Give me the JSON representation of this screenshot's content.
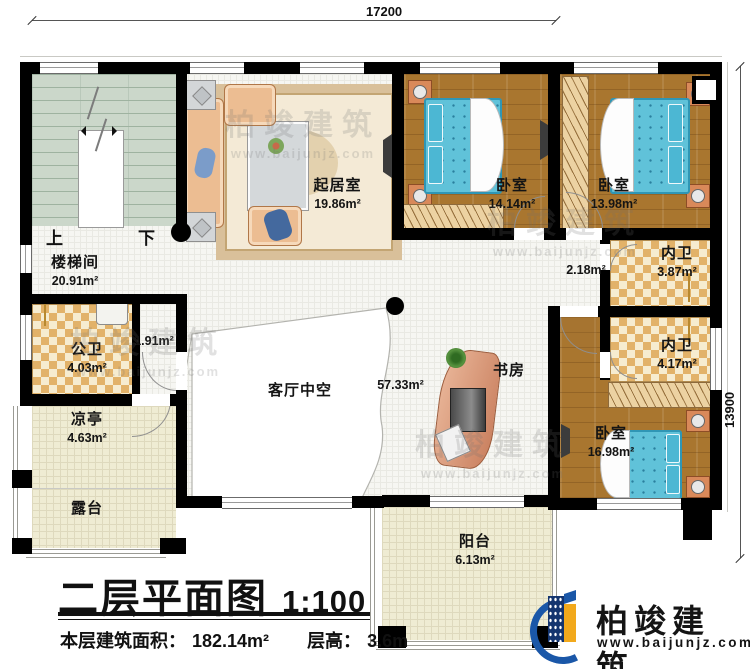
{
  "dimensions": {
    "top": "17200",
    "right": "13900"
  },
  "stairs": {
    "up": "上",
    "down": "下"
  },
  "rooms": {
    "stairwell": {
      "name": "楼梯间",
      "area": "20.91m²"
    },
    "living": {
      "name": "起居室",
      "area": "19.86m²"
    },
    "bedroom1": {
      "name": "卧室",
      "area": "14.14m²"
    },
    "bedroom2": {
      "name": "卧室",
      "area": "13.98m²"
    },
    "bath_top": {
      "name": "内卫",
      "area": "3.87m²"
    },
    "hall_small": {
      "area": "2.18m²"
    },
    "bath_mid": {
      "name": "内卫",
      "area": "4.17m²"
    },
    "bedroom3": {
      "name": "卧室",
      "area": "16.98m²"
    },
    "void": {
      "name": "客厅中空"
    },
    "hall_area": {
      "area": "57.33m²"
    },
    "study": {
      "name": "书房"
    },
    "public_bath": {
      "name": "公卫",
      "area": "4.03m²"
    },
    "closet_small": {
      "area": "1.91m²"
    },
    "pavilion": {
      "name": "凉亭",
      "area": "4.63m²"
    },
    "terrace": {
      "name": "露台"
    },
    "balcony": {
      "name": "阳台",
      "area": "6.13m²"
    }
  },
  "title_block": {
    "title": "二层平面图",
    "scale": "1:100",
    "area_label": "本层建筑面积：",
    "area_value": "182.14m²",
    "floor_height_label": "层高：",
    "floor_height_value": "3.6m"
  },
  "branding": {
    "name": "柏竣建筑",
    "url": "www.baijunjz.com"
  },
  "watermark": {
    "name": "柏竣建筑",
    "url": "www.baijunjz.com"
  },
  "colors": {
    "wall": "#000000",
    "wood_floor": "#a9762f",
    "bed_blue": "#60c2d9",
    "tile_tan": "#e2b269",
    "cream_floor": "#efecd3",
    "stair_green": "#cbd7ca",
    "brand_blue": "#1a57a8",
    "brand_yellow": "#f2a91c"
  }
}
